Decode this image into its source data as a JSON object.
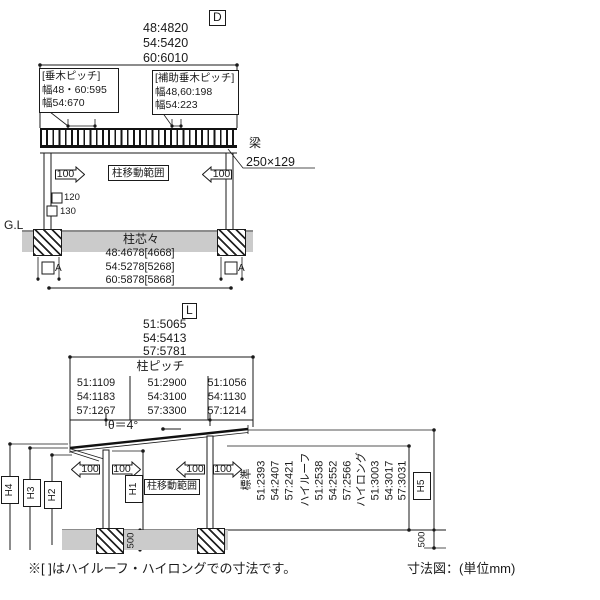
{
  "front_view": {
    "label": "D",
    "widths": [
      "48:4820",
      "54:5420",
      "60:6010"
    ],
    "rafter_pitch": {
      "title": "[垂木ピッチ]",
      "row1": "幅48・60:595",
      "row2": "幅54:670"
    },
    "aux_rafter_pitch": {
      "title": "[補助垂木ピッチ]",
      "row1": "幅48,60:198",
      "row2": "幅54:223"
    },
    "beam_name": "梁",
    "beam_size": "250×129",
    "move_range": "柱移動範囲",
    "arrow_value": "100",
    "column_width": "120",
    "column_depth": "130",
    "ground_line": "G.L",
    "post_centers_title": "柱芯々",
    "post_centers": [
      "48:4678[4668]",
      "54:5278[5268]",
      "60:5878[5868]"
    ],
    "section_marker": "A"
  },
  "side_view": {
    "label": "L",
    "depths": [
      "51:5065",
      "54:5413",
      "57:5781"
    ],
    "pitch_title": "柱ピッチ",
    "pitch_front": [
      "51:1109",
      "54:1183",
      "57:1267"
    ],
    "pitch_middle": [
      "51:2900",
      "54:3100",
      "57:3300"
    ],
    "pitch_rear": [
      "51:1056",
      "54:1130",
      "57:1214"
    ],
    "roof_angle": "θ＝4°",
    "move_range": "柱移動範囲",
    "arrow_value": "100",
    "h1": "H1",
    "h2": "H2",
    "h3": "H3",
    "h4": "H4",
    "h5": "H5",
    "heights": [
      "標準",
      "51:2393",
      "54:2407",
      "57:2421",
      "ハイルーフ",
      "51:2538",
      "54:2552",
      "57:2566",
      "ハイロング",
      "51:3003",
      "54:3017",
      "57:3031"
    ],
    "footing_depth": "500"
  },
  "footer": {
    "note": "※[ ]はハイルーフ・ハイロングでの寸法です。",
    "caption": "寸法図：(単位mm)"
  },
  "colors": {
    "line": "#1a1a1a",
    "ground_fill": "#cbcbcb"
  }
}
